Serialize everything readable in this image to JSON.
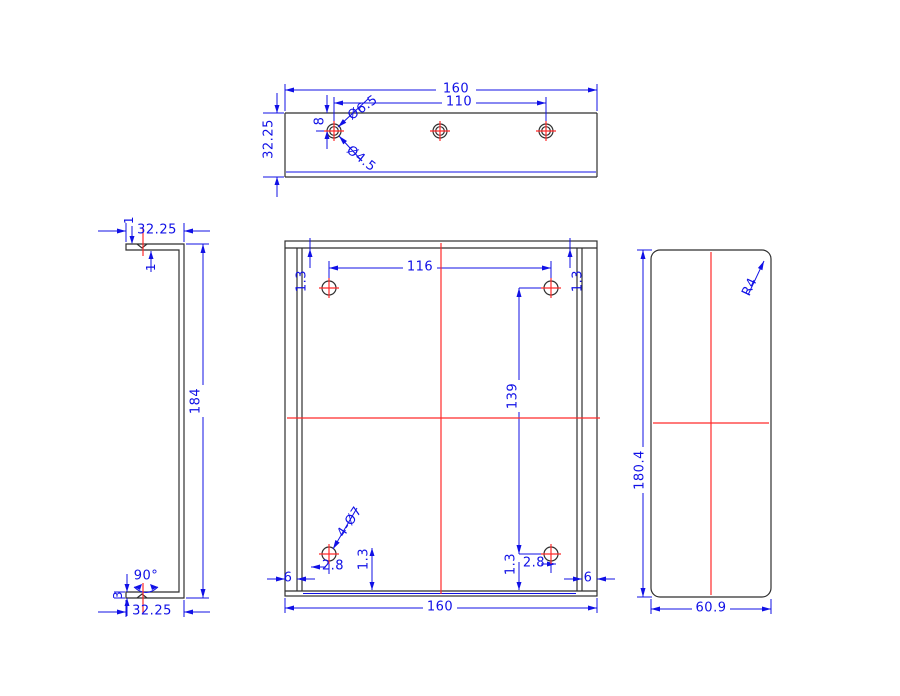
{
  "colors": {
    "dimension_blue": "#1010e6",
    "centerline_red": "#ff2a2a",
    "geometry_gray": "#2f2f2f",
    "background": "#ffffff"
  },
  "views": {
    "top_view": {
      "dims": {
        "width": "160",
        "hole_spacing": "110",
        "hole_edge_offset": "8",
        "counterbore": "Ø6.5",
        "drill": "Ø4.5",
        "height": "32.25"
      }
    },
    "left_side_view": {
      "dims": {
        "flange_top": "32.25",
        "thickness_outer": "1",
        "thickness_inner": "1",
        "height": "184",
        "bend_angle": "90°",
        "thickness": "3",
        "flange_bottom": "32.25"
      }
    },
    "front_view": {
      "dims": {
        "hole_span_x": "116",
        "edge_tl": "1.3",
        "edge_tr": "1.3",
        "hole_span_y": "139",
        "edge_bl": "1.3",
        "edge_br": "1.3",
        "offset_bl": "2.8",
        "offset_br": "2.8",
        "flange_left": "6",
        "flange_right": "6",
        "width": "160",
        "hole_callout": "4-Ø7"
      }
    },
    "right_side_view": {
      "dims": {
        "corner_radius": "R4",
        "height": "180.4",
        "depth": "60.9"
      }
    }
  }
}
